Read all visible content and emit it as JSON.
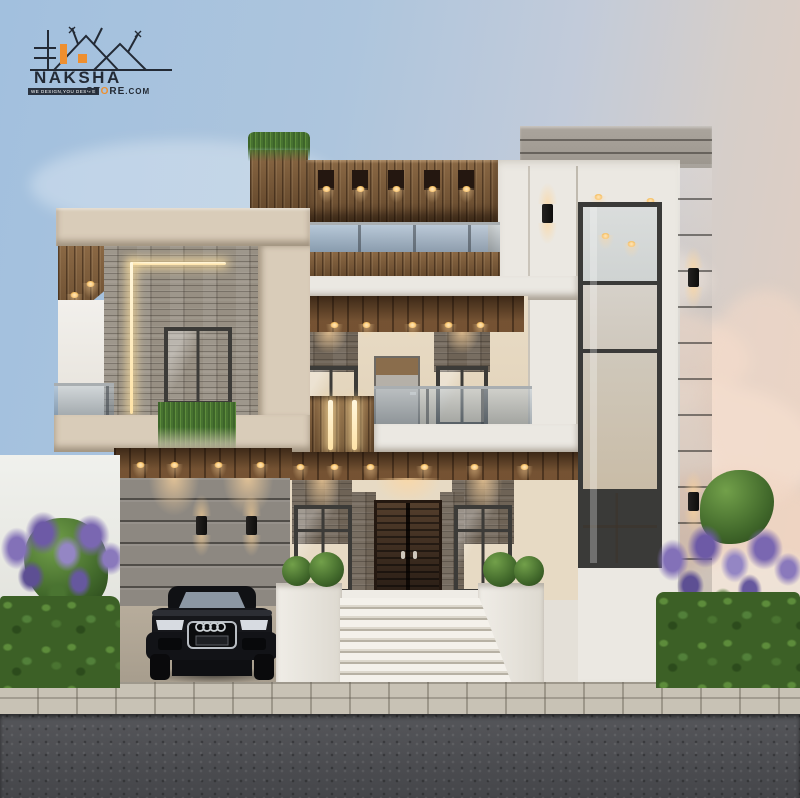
{
  "meta": {
    "type": "architectural-exterior-3d-render",
    "time_of_day": "dusk",
    "canvas_width": 800,
    "canvas_height": 798
  },
  "logo": {
    "brand": "NAKSHA",
    "store_prefix": "ST",
    "store_o": "O",
    "store_suffix": "RE",
    "store_tld": ".COM",
    "tagline": "WE DESIGN,YOU DESIRE",
    "brand_color": "#232a35",
    "accent_color": "#ee8f2f"
  },
  "palette": {
    "sky_top": "#a2c0de",
    "sky_horizon": "#e4cfc0",
    "cloud_pink": "#f2d8c6",
    "wall_cream": "#d9ccb9",
    "wall_white": "#ebe8e2",
    "wood": "#7a5836",
    "wood_ceiling": "#5e3f24",
    "stone": "#978f83",
    "stone_dark": "#6e6356",
    "panel_gray": "#8d8881",
    "railing_glass": "#93a4b2",
    "window_warm": "#e6d9c2",
    "door_wood": "#33241a",
    "accent_light_warm": "#ffd9a3",
    "road_asphalt": "#4c4d51",
    "sidewalk_paver": "#c8c2b5",
    "hedge_green": "#3c6026",
    "flower_purple": "#7f6cb4",
    "car_black": "#17181c"
  },
  "scene": {
    "description": "Modern two-storey duplex house exterior render at dusk with warm accent lighting",
    "objects": [
      "rooftop wood pergola with recessed lights",
      "rooftop glass railing",
      "stone feature wall with L-shaped LED strip",
      "vertical wood slat cladding with LED strips",
      "first-floor balcony with glass railing",
      "double-height glazed tower window",
      "gray fluted side wall with up-down sconces",
      "carport with gray panel wall and wall sconces",
      "black sedan parked in carport",
      "dark wood double entrance door",
      "white entrance staircase",
      "planter boxes with round topiary bushes",
      "purple flowering hedges",
      "paver sidewalk and asphalt road"
    ]
  }
}
